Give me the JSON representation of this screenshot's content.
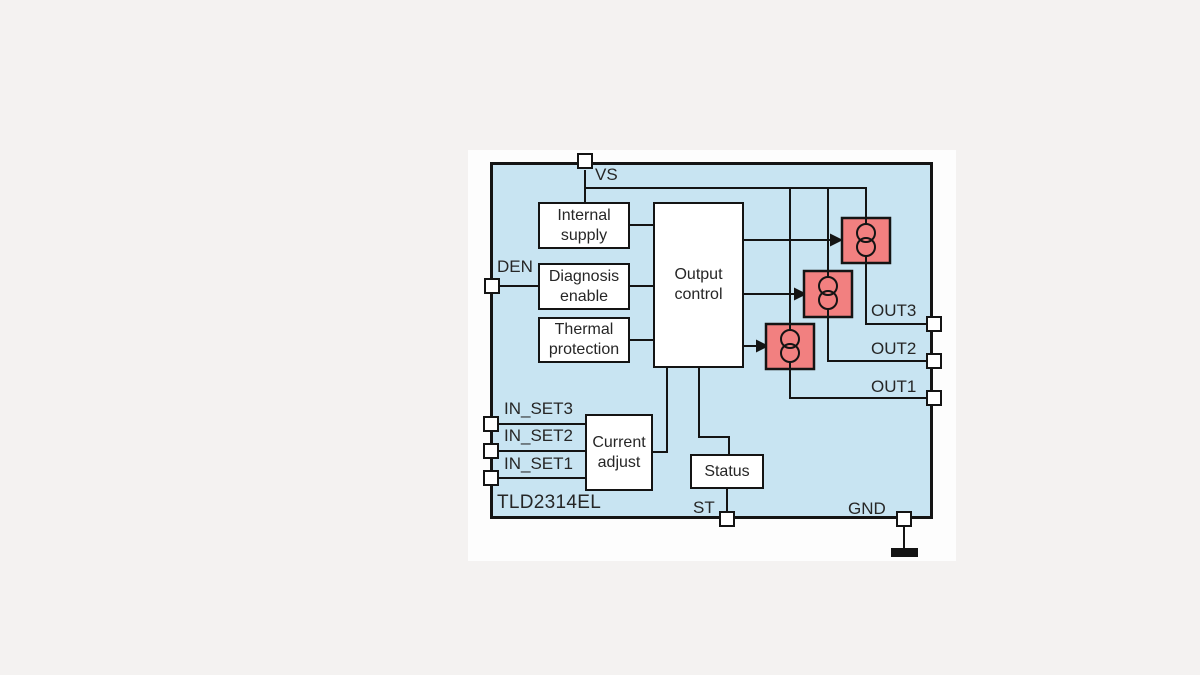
{
  "figure": {
    "part_label": "TLD2314EL",
    "blocks": {
      "internal_supply": "Internal supply",
      "diagnosis_enable": "Diagnosis enable",
      "thermal_protection": "Thermal protection",
      "output_control": "Output control",
      "current_adjust": "Current adjust",
      "status": "Status"
    },
    "pins": {
      "vs": "VS",
      "den": "DEN",
      "in_set3": "IN_SET3",
      "in_set2": "IN_SET2",
      "in_set1": "IN_SET1",
      "out3": "OUT3",
      "out2": "OUT2",
      "out1": "OUT1",
      "st": "ST",
      "gnd": "GND"
    },
    "symbols": {
      "current_source_count": 3,
      "ground": "ground-symbol"
    },
    "colors": {
      "page_bg": "#f4f2f1",
      "panel_bg": "#fdfdfd",
      "chip_fill": "#c8e4f2",
      "line": "#141414",
      "box_fill": "#ffffff",
      "cs_fill": "#f28080",
      "text": "#262626"
    }
  }
}
